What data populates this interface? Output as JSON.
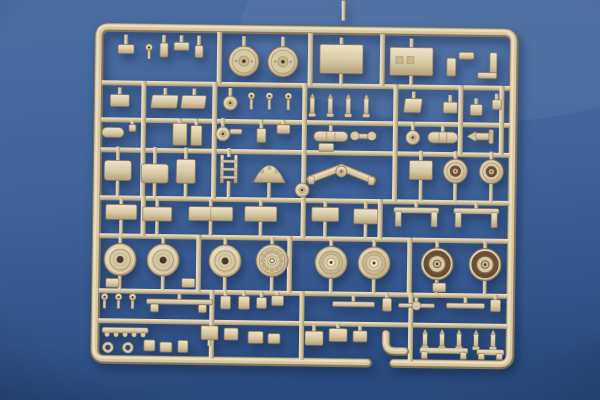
{
  "scene": {
    "subject": "tan plastic model-kit sprue (parts tree) photographed on a blue surface",
    "sprue_color_name": "tan",
    "background_color_name": "blue"
  },
  "colors": {
    "bg_top": "#4a6da2",
    "bg_mid": "#3f639a",
    "bg_bottom": "#31548a",
    "bg_deep": "#284a7c",
    "plastic_light": "#efe4c6",
    "plastic_base": "#d7c8a4",
    "plastic_mid": "#c7b690",
    "plastic_dark": "#a08d6a",
    "plastic_deep": "#85745a",
    "box_shade": "#b3a07b",
    "rim_brown": "#6b4e33",
    "hole_dark": "#463b2b"
  },
  "sprue": {
    "frame": {
      "x": 97,
      "y": 30,
      "w": 415,
      "h": 332,
      "rx": 10,
      "gap_from": 370,
      "gap_to": 396
    },
    "rails_h": [
      {
        "x": 100,
        "y": 83,
        "w": 409
      },
      {
        "x": 100,
        "y": 120,
        "w": 409
      },
      {
        "x": 100,
        "y": 150,
        "w": 409
      },
      {
        "x": 100,
        "y": 198,
        "w": 409
      },
      {
        "x": 100,
        "y": 236,
        "w": 409
      },
      {
        "x": 100,
        "y": 291,
        "w": 409
      },
      {
        "x": 100,
        "y": 321,
        "w": 409
      }
    ],
    "rails_v": [
      {
        "x": 215,
        "y": 33,
        "h": 52
      },
      {
        "x": 306,
        "y": 33,
        "h": 52
      },
      {
        "x": 378,
        "y": 33,
        "h": 52
      },
      {
        "x": 140,
        "y": 83,
        "h": 117
      },
      {
        "x": 211,
        "y": 83,
        "h": 117
      },
      {
        "x": 301,
        "y": 83,
        "h": 155
      },
      {
        "x": 392,
        "y": 83,
        "h": 117
      },
      {
        "x": 457,
        "y": 83,
        "h": 69
      },
      {
        "x": 498,
        "y": 83,
        "h": 69
      },
      {
        "x": 141,
        "y": 198,
        "h": 40
      },
      {
        "x": 378,
        "y": 198,
        "h": 40
      },
      {
        "x": 197,
        "y": 236,
        "h": 57
      },
      {
        "x": 288,
        "y": 236,
        "h": 57
      },
      {
        "x": 408,
        "y": 236,
        "h": 57
      },
      {
        "x": 211,
        "y": 291,
        "h": 69
      },
      {
        "x": 301,
        "y": 291,
        "h": 69
      },
      {
        "x": 410,
        "y": 291,
        "h": 69
      }
    ],
    "parts": [
      {
        "t": "box",
        "x": 116,
        "y": 47,
        "w": 16,
        "h": 9,
        "su": 10
      },
      {
        "t": "pin",
        "x": 147,
        "y": 46,
        "h": 11
      },
      {
        "t": "box",
        "x": 158,
        "y": 45,
        "w": 8,
        "h": 14,
        "su": 8
      },
      {
        "t": "box",
        "x": 172,
        "y": 44,
        "w": 15,
        "h": 8,
        "su": 7
      },
      {
        "t": "box",
        "x": 193,
        "y": 47,
        "w": 8,
        "h": 12,
        "su": 10
      },
      {
        "t": "wheel",
        "cx": 242,
        "cy": 62,
        "r": 15,
        "v": "top",
        "su": 10
      },
      {
        "t": "wheel",
        "cx": 281,
        "cy": 62,
        "r": 15,
        "v": "top",
        "su": 10
      },
      {
        "t": "box",
        "x": 318,
        "y": 44,
        "w": 43,
        "h": 29,
        "su": 7,
        "sd": 11
      },
      {
        "t": "box",
        "x": 388,
        "y": 46,
        "w": 43,
        "h": 28,
        "su": 9,
        "sd": 10,
        "marks": true
      },
      {
        "t": "box",
        "x": 445,
        "y": 56,
        "w": 9,
        "h": 18
      },
      {
        "t": "box",
        "x": 457,
        "y": 50,
        "w": 15,
        "h": 7
      },
      {
        "t": "box",
        "x": 488,
        "y": 50,
        "w": 7,
        "h": 23
      },
      {
        "t": "box",
        "x": 476,
        "y": 70,
        "w": 19,
        "h": 6
      },
      {
        "t": "box",
        "x": 109,
        "y": 97,
        "w": 19,
        "h": 12,
        "su": 7
      },
      {
        "t": "seat",
        "x": 151,
        "y": 97,
        "w": 26,
        "h": 13,
        "su": 7
      },
      {
        "t": "seat",
        "x": 181,
        "y": 97,
        "w": 24,
        "h": 13,
        "su": 7
      },
      {
        "t": "disc",
        "cx": 229,
        "cy": 104,
        "r": 7,
        "su": 8
      },
      {
        "t": "pin",
        "x": 250,
        "y": 93,
        "h": 13
      },
      {
        "t": "pin",
        "x": 268,
        "y": 93,
        "h": 13
      },
      {
        "t": "pin",
        "x": 287,
        "y": 93,
        "h": 13
      },
      {
        "t": "peg",
        "x": 311,
        "y": 93,
        "h": 17
      },
      {
        "t": "peg",
        "x": 329,
        "y": 93,
        "h": 17
      },
      {
        "t": "peg",
        "x": 347,
        "y": 93,
        "h": 17
      },
      {
        "t": "peg",
        "x": 365,
        "y": 93,
        "h": 17
      },
      {
        "t": "seat",
        "x": 404,
        "y": 97,
        "w": 17,
        "h": 14,
        "su": 7
      },
      {
        "t": "box",
        "x": 442,
        "y": 100,
        "w": 14,
        "h": 11,
        "su": 7
      },
      {
        "t": "box",
        "x": 469,
        "y": 102,
        "w": 12,
        "h": 11,
        "su": 6
      },
      {
        "t": "box",
        "x": 491,
        "y": 97,
        "w": 9,
        "h": 10,
        "su": 6
      },
      {
        "t": "cyl",
        "x": 101,
        "y": 130,
        "w": 22,
        "h": 10
      },
      {
        "t": "box",
        "x": 128,
        "y": 127,
        "w": 7,
        "h": 7,
        "su": 4
      },
      {
        "t": "box",
        "x": 172,
        "y": 125,
        "w": 14,
        "h": 22,
        "su": 5
      },
      {
        "t": "box",
        "x": 190,
        "y": 127,
        "w": 11,
        "h": 20,
        "su": 7
      },
      {
        "t": "disc",
        "cx": 222,
        "cy": 135,
        "r": 7,
        "su": 9
      },
      {
        "t": "box",
        "x": 229,
        "y": 130,
        "w": 12,
        "h": 5
      },
      {
        "t": "box",
        "x": 256,
        "y": 129,
        "w": 9,
        "h": 14,
        "su": 9
      },
      {
        "t": "box",
        "x": 276,
        "y": 125,
        "w": 13,
        "h": 9,
        "su": 5
      },
      {
        "t": "cyl",
        "x": 313,
        "y": 131,
        "w": 34,
        "h": 10,
        "ribs": true,
        "su": 6
      },
      {
        "t": "box",
        "x": 318,
        "y": 143,
        "w": 15,
        "h": 8
      },
      {
        "t": "bar",
        "x": 352,
        "y": 133,
        "w": 21,
        "h": 5
      },
      {
        "t": "ring",
        "cx": 354,
        "cy": 135,
        "r": 3
      },
      {
        "t": "ring",
        "cx": 371,
        "cy": 135,
        "r": 3
      },
      {
        "t": "disc",
        "cx": 412,
        "cy": 136,
        "r": 7,
        "su": 9
      },
      {
        "t": "cyl",
        "x": 427,
        "y": 130,
        "w": 30,
        "h": 11,
        "ribs": true,
        "su": 6
      },
      {
        "t": "dart",
        "x": 466,
        "y": 129,
        "w": 30,
        "h": 10
      },
      {
        "t": "box",
        "x": 104,
        "y": 163,
        "w": 27,
        "h": 20,
        "rx": 3,
        "su": 14,
        "sd": 16
      },
      {
        "t": "box",
        "x": 141,
        "y": 166,
        "w": 27,
        "h": 19,
        "rx": 3,
        "su": 17,
        "sd": 14
      },
      {
        "t": "box",
        "x": 176,
        "y": 161,
        "w": 19,
        "h": 24,
        "rx": 2,
        "su": 12,
        "sd": 14
      },
      {
        "t": "ladder",
        "x": 220,
        "y": 156,
        "w": 17,
        "h": 28,
        "su": 7,
        "sd": 15
      },
      {
        "t": "dome",
        "x": 253,
        "y": 167,
        "w": 32,
        "h": 16,
        "sd": 16
      },
      {
        "t": "disc",
        "cx": 302,
        "cy": 190,
        "r": 7
      },
      {
        "t": "wing",
        "cx": 341,
        "cy": 171,
        "span": 62,
        "su": 6,
        "sd": 18
      },
      {
        "t": "box",
        "x": 409,
        "y": 159,
        "w": 23,
        "h": 19,
        "su": 10,
        "sd": 21
      },
      {
        "t": "wheel",
        "cx": 455,
        "cy": 169,
        "r": 12,
        "v": "small",
        "su": 8,
        "sd": 18
      },
      {
        "t": "wheel",
        "cx": 491,
        "cy": 169,
        "r": 12,
        "v": "small",
        "su": 8,
        "sd": 18
      },
      {
        "t": "box",
        "x": 106,
        "y": 207,
        "w": 31,
        "h": 15,
        "su": 6,
        "sd": 15
      },
      {
        "t": "box",
        "x": 143,
        "y": 209,
        "w": 29,
        "h": 14,
        "su": 8,
        "sd": 14
      },
      {
        "t": "box",
        "x": 189,
        "y": 208,
        "w": 44,
        "h": 14,
        "seam": true,
        "su": 7,
        "sd": 15
      },
      {
        "t": "box",
        "x": 245,
        "y": 207,
        "w": 32,
        "h": 15,
        "su": 6,
        "sd": 15
      },
      {
        "t": "box",
        "x": 312,
        "y": 207,
        "w": 27,
        "h": 14,
        "su": 6,
        "sd": 16
      },
      {
        "t": "box",
        "x": 354,
        "y": 208,
        "w": 24,
        "h": 15,
        "su": 7,
        "sd": 14
      },
      {
        "t": "fender",
        "x": 394,
        "y": 206,
        "w": 45,
        "h": 19,
        "su": 6
      },
      {
        "t": "fender",
        "x": 454,
        "y": 206,
        "w": 45,
        "h": 19,
        "su": 6
      },
      {
        "t": "wheel",
        "cx": 121,
        "cy": 262,
        "r": 16,
        "v": "plain",
        "su": 7,
        "sd": 14
      },
      {
        "t": "wheel",
        "cx": 164,
        "cy": 262,
        "r": 16,
        "v": "plain",
        "su": 7,
        "sd": 14
      },
      {
        "t": "wheel",
        "cx": 226,
        "cy": 262,
        "r": 16,
        "v": "plain",
        "su": 7,
        "sd": 14
      },
      {
        "t": "wheel",
        "cx": 273,
        "cy": 261,
        "r": 16,
        "v": "drum",
        "su": 7,
        "sd": 15
      },
      {
        "t": "wheel",
        "cx": 332,
        "cy": 262,
        "r": 16,
        "v": "hub",
        "su": 7,
        "sd": 14
      },
      {
        "t": "wheel",
        "cx": 375,
        "cy": 262,
        "r": 16,
        "v": "hub",
        "su": 7,
        "sd": 14
      },
      {
        "t": "wheel",
        "cx": 438,
        "cy": 262,
        "r": 16,
        "v": "rim",
        "su": 7,
        "sd": 14
      },
      {
        "t": "wheel",
        "cx": 486,
        "cy": 262,
        "r": 16,
        "v": "rim",
        "su": 7,
        "sd": 14
      },
      {
        "t": "box",
        "x": 107,
        "y": 281,
        "w": 13,
        "h": 9
      },
      {
        "t": "box",
        "x": 183,
        "y": 280,
        "w": 13,
        "h": 9
      },
      {
        "t": "box",
        "x": 434,
        "y": 281,
        "w": 13,
        "h": 9
      },
      {
        "t": "pin",
        "x": 106,
        "y": 296,
        "h": 11
      },
      {
        "t": "pin",
        "x": 120,
        "y": 296,
        "h": 11
      },
      {
        "t": "pin",
        "x": 134,
        "y": 296,
        "h": 11
      },
      {
        "t": "bar",
        "x": 148,
        "y": 301,
        "w": 66,
        "h": 5,
        "su": 5
      },
      {
        "t": "box",
        "x": 152,
        "y": 306,
        "w": 8,
        "h": 8
      },
      {
        "t": "box",
        "x": 200,
        "y": 306,
        "w": 8,
        "h": 8
      },
      {
        "t": "box",
        "x": 222,
        "y": 297,
        "w": 10,
        "h": 13,
        "su": 5
      },
      {
        "t": "box",
        "x": 240,
        "y": 297,
        "w": 11,
        "h": 13,
        "su": 5
      },
      {
        "t": "box",
        "x": 258,
        "y": 298,
        "w": 10,
        "h": 11,
        "su": 6
      },
      {
        "t": "box",
        "x": 273,
        "y": 296,
        "w": 12,
        "h": 10,
        "su": 4
      },
      {
        "t": "bar",
        "x": 334,
        "y": 301,
        "w": 42,
        "h": 5,
        "su": 6
      },
      {
        "t": "box",
        "x": 384,
        "y": 297,
        "w": 9,
        "h": 13,
        "su": 5
      },
      {
        "t": "bar",
        "x": 400,
        "y": 302,
        "w": 36,
        "h": 4,
        "su": 6
      },
      {
        "t": "ring",
        "cx": 418,
        "cy": 304,
        "r": 3
      },
      {
        "t": "bar",
        "x": 448,
        "y": 301,
        "w": 38,
        "h": 5,
        "su": 6
      },
      {
        "t": "box",
        "x": 492,
        "y": 297,
        "w": 10,
        "h": 12,
        "su": 5
      },
      {
        "t": "zigzag",
        "x": 104,
        "y": 330,
        "w": 46
      },
      {
        "t": "ring",
        "cx": 110,
        "cy": 350,
        "r": 4
      },
      {
        "t": "ring",
        "cx": 130,
        "cy": 350,
        "r": 4
      },
      {
        "t": "box",
        "x": 146,
        "y": 342,
        "w": 11,
        "h": 11
      },
      {
        "t": "box",
        "x": 162,
        "y": 344,
        "w": 12,
        "h": 10
      },
      {
        "t": "box",
        "x": 180,
        "y": 342,
        "w": 10,
        "h": 12
      },
      {
        "t": "box",
        "x": 203,
        "y": 327,
        "w": 17,
        "h": 14,
        "sd": 6
      },
      {
        "t": "box",
        "x": 226,
        "y": 329,
        "w": 14,
        "h": 12
      },
      {
        "t": "box",
        "x": 250,
        "y": 332,
        "w": 15,
        "h": 12
      },
      {
        "t": "box",
        "x": 270,
        "y": 334,
        "w": 12,
        "h": 10
      },
      {
        "t": "box",
        "x": 307,
        "y": 331,
        "w": 18,
        "h": 14,
        "su": 6
      },
      {
        "t": "box",
        "x": 331,
        "y": 328,
        "w": 18,
        "h": 13,
        "su": 5
      },
      {
        "t": "box",
        "x": 355,
        "y": 330,
        "w": 14,
        "h": 11,
        "su": 5
      },
      {
        "t": "elbow",
        "x": 388,
        "y": 335
      },
      {
        "t": "peg",
        "x": 427,
        "y": 327,
        "h": 14
      },
      {
        "t": "peg",
        "x": 444,
        "y": 327,
        "h": 14
      },
      {
        "t": "peg",
        "x": 461,
        "y": 327,
        "h": 14
      },
      {
        "t": "peg",
        "x": 478,
        "y": 327,
        "h": 14
      },
      {
        "t": "peg",
        "x": 495,
        "y": 327,
        "h": 14
      },
      {
        "t": "fender",
        "x": 422,
        "y": 346,
        "w": 48,
        "h": 11
      },
      {
        "t": "fender",
        "x": 479,
        "y": 347,
        "w": 27,
        "h": 10
      }
    ]
  }
}
